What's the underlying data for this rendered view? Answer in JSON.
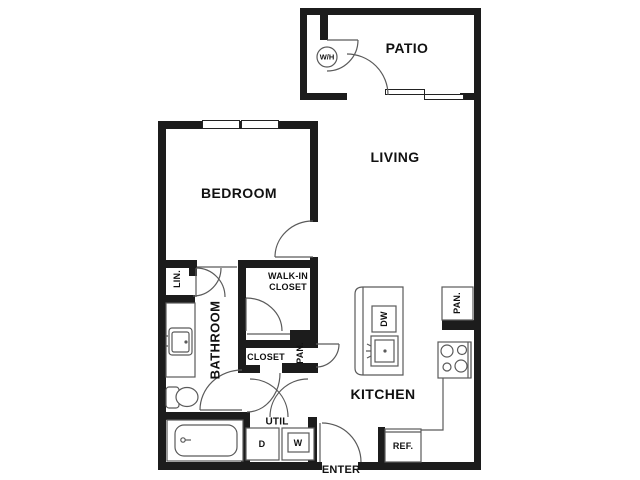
{
  "title": "Apartment floor plan",
  "colors": {
    "wall": "#1c1c1c",
    "line": "#5a5a5a",
    "text": "#111111",
    "background": "#ffffff"
  },
  "rooms": {
    "patio": "PATIO",
    "living": "LIVING",
    "bedroom": "BEDROOM",
    "kitchen": "KITCHEN",
    "bathroom": "BATHROOM",
    "walk_in_closet_line1": "WALK-IN",
    "walk_in_closet_line2": "CLOSET",
    "closet": "CLOSET",
    "util": "UTIL"
  },
  "labels": {
    "linen": "LIN.",
    "pantry_hall": "PAN.",
    "pantry_kitchen": "PAN.",
    "water_heater": "W/H",
    "dishwasher": "DW",
    "dryer": "D",
    "washer": "W",
    "refrigerator": "REF.",
    "enter": "ENTER"
  },
  "fixtures": [
    "water-heater",
    "bathroom-vanity-sink",
    "toilet",
    "bathtub",
    "kitchen-island",
    "kitchen-sink",
    "dishwasher",
    "stove",
    "refrigerator",
    "dryer",
    "washer",
    "pantry-cabinet"
  ]
}
